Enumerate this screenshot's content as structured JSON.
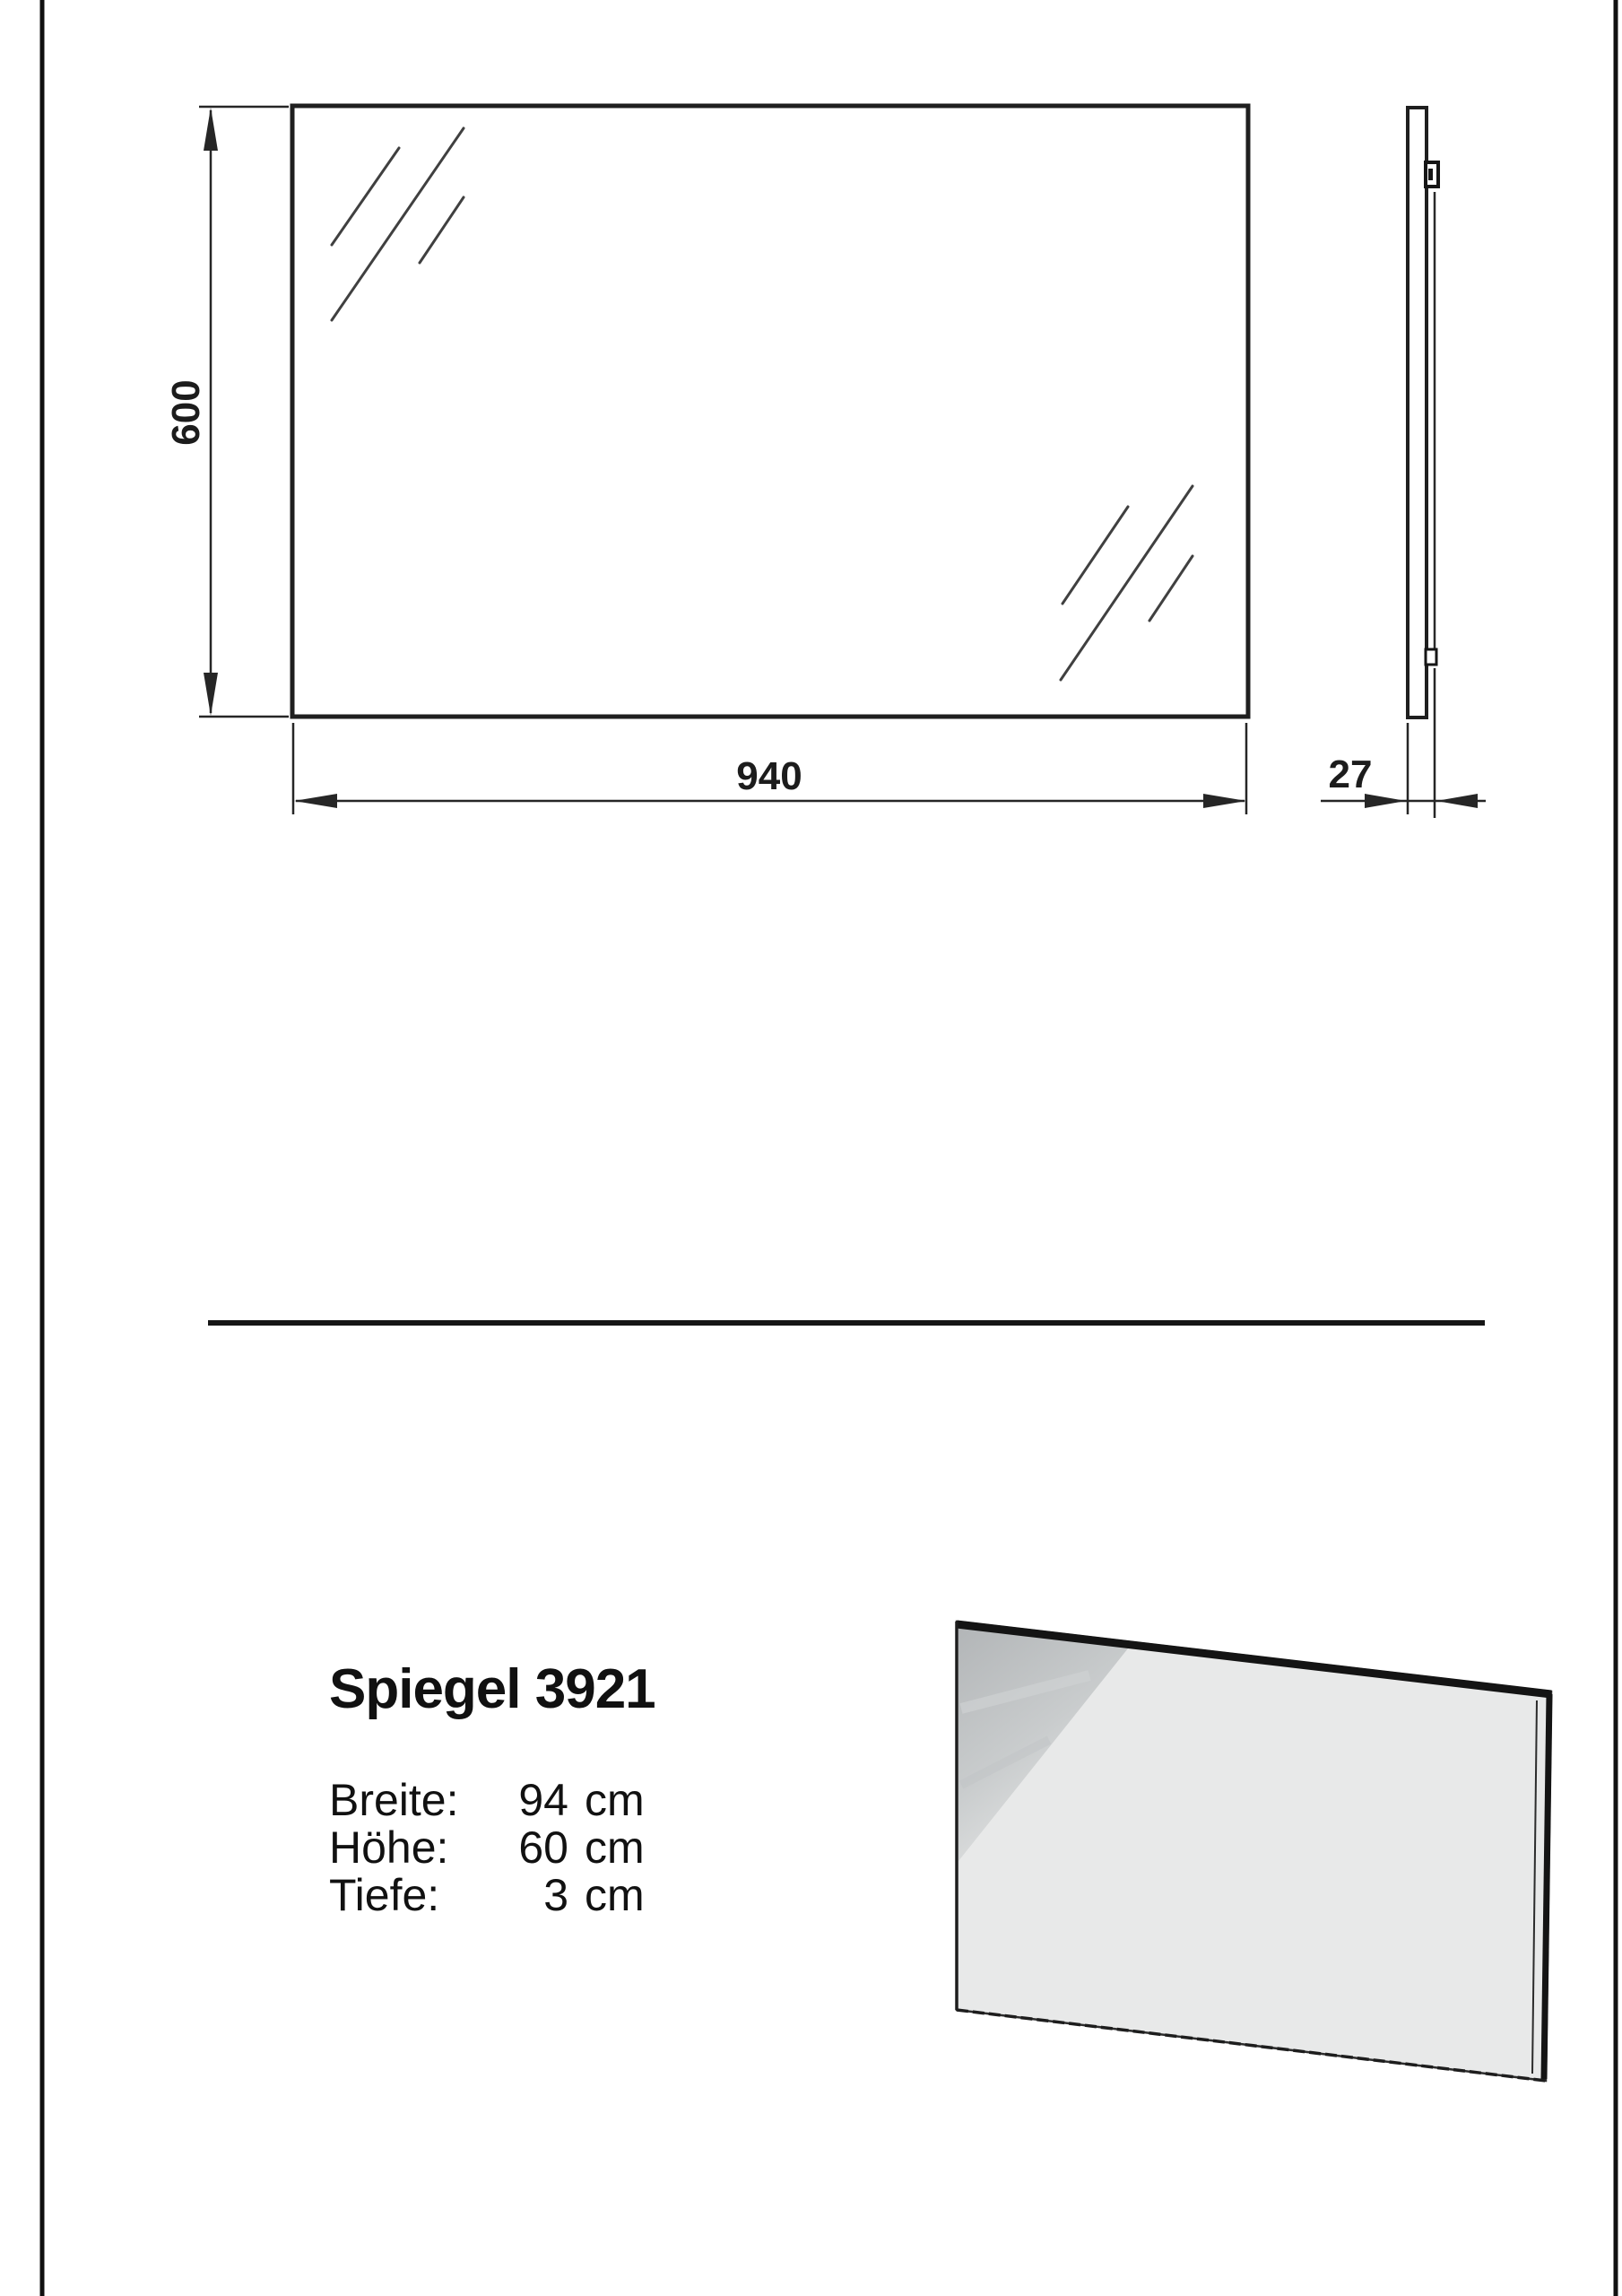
{
  "technical_drawing": {
    "front_view": {
      "height_label": "600",
      "width_label": "940"
    },
    "side_view": {
      "depth_label": "27"
    }
  },
  "product_info": {
    "title": "Spiegel 3921",
    "specs": [
      {
        "label": "Breite:",
        "value": "94",
        "unit": "cm"
      },
      {
        "label": "Höhe:",
        "value": "60",
        "unit": "cm"
      },
      {
        "label": "Tiefe:",
        "value": "3",
        "unit": "cm"
      }
    ]
  },
  "colors": {
    "line": "#1f1f1f",
    "mirror_face": "#e8e9e9",
    "reflection_gray": "#b7babc"
  }
}
